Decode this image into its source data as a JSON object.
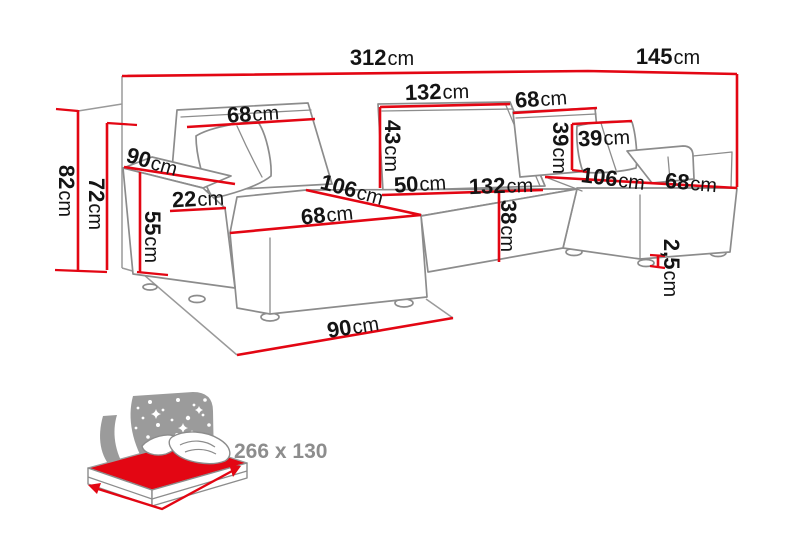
{
  "diagram": {
    "title": "corner-sofa-dimension-diagram",
    "unit": "cm",
    "colors": {
      "dimension_red": "#e30613",
      "outline_gray": "#8c8c8c",
      "label_black": "#141414",
      "bed_text_gray": "#8d8d8d",
      "bed_backdrop_gray": "#9b9b9b",
      "background": "#ffffff"
    },
    "dimensions": {
      "total_width": {
        "value": "312",
        "unit": "cm"
      },
      "right_depth": {
        "value": "145",
        "unit": "cm"
      },
      "back_mid_width": {
        "value": "132",
        "unit": "cm"
      },
      "back_left_width": {
        "value": "68",
        "unit": "cm"
      },
      "back_right_width": {
        "value": "68",
        "unit": "cm"
      },
      "backrest_height": {
        "value": "43",
        "unit": "cm"
      },
      "pillow_width": {
        "value": "39",
        "unit": "cm"
      },
      "pillow_height": {
        "value": "39",
        "unit": "cm"
      },
      "armrest_depth": {
        "value": "90",
        "unit": "cm"
      },
      "armrest_width": {
        "value": "22",
        "unit": "cm"
      },
      "armrest_height": {
        "value": "55",
        "unit": "cm"
      },
      "back_panel_height": {
        "value": "72",
        "unit": "cm"
      },
      "total_height": {
        "value": "82",
        "unit": "cm"
      },
      "left_chaise_length": {
        "value": "106",
        "unit": "cm"
      },
      "left_seat_width": {
        "value": "68",
        "unit": "cm"
      },
      "seat_depth": {
        "value": "50",
        "unit": "cm"
      },
      "mid_seat_width": {
        "value": "132",
        "unit": "cm"
      },
      "right_chaise_length": {
        "value": "106",
        "unit": "cm"
      },
      "right_seat_width": {
        "value": "68",
        "unit": "cm"
      },
      "seat_height": {
        "value": "38",
        "unit": "cm"
      },
      "chaise_floor_depth": {
        "value": "90",
        "unit": "cm"
      },
      "leg_height": {
        "value": "2,5",
        "unit": "cm"
      }
    },
    "bed_icon": {
      "sleeping_area": "266 x 130"
    }
  }
}
